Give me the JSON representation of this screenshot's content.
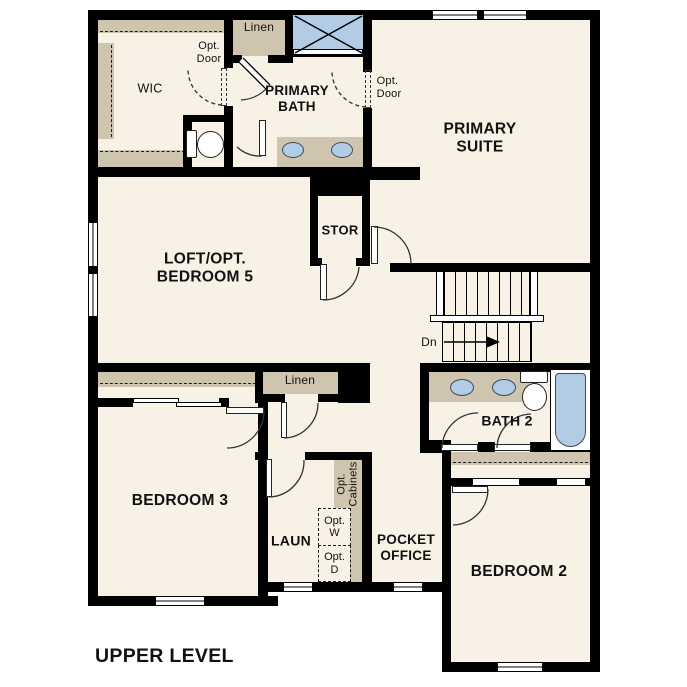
{
  "title": "UPPER LEVEL",
  "palette": {
    "floor": "#f7f1e6",
    "wall": "#000000",
    "casework": "#cfc5ae",
    "fixture_blue": "#b3cce6"
  },
  "rooms": {
    "wic": "WIC",
    "primary_bath": "PRIMARY\nBATH",
    "primary_suite": "PRIMARY\nSUITE",
    "stor": "STOR",
    "loft": "LOFT/OPT.\nBEDROOM 5",
    "bedroom3": "BEDROOM 3",
    "bath2": "BATH 2",
    "laundry": "LAUN",
    "pocket_office": "POCKET\nOFFICE",
    "bedroom2": "BEDROOM 2"
  },
  "closets": {
    "linen_top": "Linen",
    "linen_hall": "Linen"
  },
  "annotations": {
    "opt_door_wic": "Opt.\nDoor",
    "opt_door_suite": "Opt.\nDoor",
    "opt_cabinets": "Opt.\nCabinets",
    "opt_washer": "Opt.\nW",
    "opt_dryer": "Opt.\nD",
    "stairs_down": "Dn"
  }
}
